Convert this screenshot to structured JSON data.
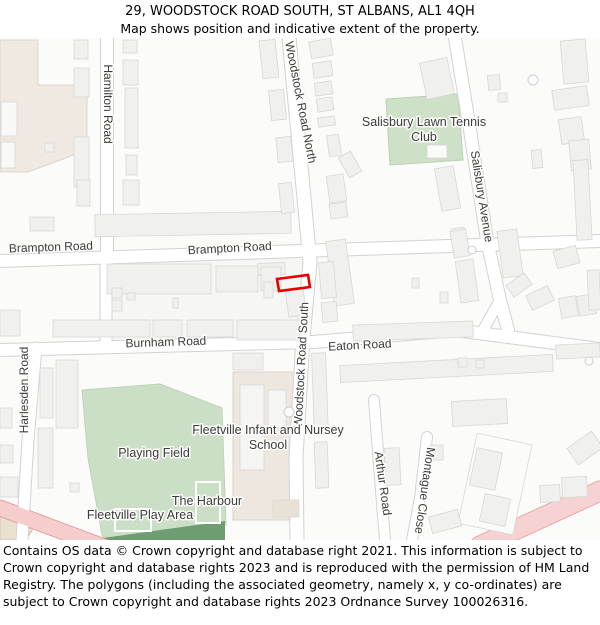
{
  "header": {
    "title": "29, WOODSTOCK ROAD SOUTH, ST ALBANS, AL1 4QH",
    "subtitle": "Map shows position and indicative extent of the property."
  },
  "footer": {
    "text": "Contains OS data © Crown copyright and database right 2021. This information is subject to Crown copyright and database rights 2023 and is reproduced with the permission of HM Land Registry. The polygons (including the associated geometry, namely x, y co-ordinates) are subject to Crown copyright and database rights 2023 Ordnance Survey 100026316."
  },
  "map": {
    "colors": {
      "land": "#fbfbfa",
      "block": "#f6f6f5",
      "building": "#f0f0ef",
      "building_stroke": "#d7d7d6",
      "road_fill": "#ffffff",
      "road_casing": "#d2d2d1",
      "green": "#cbdfc6",
      "green_dark": "#6f9d72",
      "beige": "#efe9e1",
      "pink_fill": "#f6cdcd",
      "pink_casing": "#e5a1a1",
      "label": "#3c3c3c",
      "label_halo": "#fdfdfc",
      "property": "#e60000"
    },
    "areas": [
      {
        "name": "residential-block",
        "points": [
          [
            104,
            222
          ],
          [
            313,
            214
          ],
          [
            308,
            302
          ],
          [
            104,
            306
          ]
        ],
        "fill": "#f6f6f5"
      },
      {
        "name": "beige-landuse-nw",
        "points": [
          [
            0,
            2
          ],
          [
            38,
            2
          ],
          [
            38,
            47
          ],
          [
            87,
            47
          ],
          [
            87,
            112
          ],
          [
            28,
            134
          ],
          [
            0,
            134
          ]
        ],
        "fill": "#efe9e1",
        "stroke": "#ddd5c9"
      },
      {
        "name": "tennis-club-green",
        "points": [
          [
            386,
            61
          ],
          [
            458,
            56
          ],
          [
            463,
            122
          ],
          [
            390,
            127
          ]
        ],
        "fill": "#cfe0c9",
        "stroke": "#bad2b2"
      },
      {
        "name": "playing-field-green",
        "points": [
          [
            82,
            352
          ],
          [
            160,
            346
          ],
          [
            222,
            370
          ],
          [
            226,
            487
          ],
          [
            183,
            502
          ],
          [
            103,
            502
          ],
          [
            88,
            420
          ]
        ],
        "fill": "#cbdfc6",
        "stroke": "#bcd4b6"
      },
      {
        "name": "play-area-dark-green",
        "points": [
          [
            103,
            500
          ],
          [
            225,
            483
          ],
          [
            225,
            502
          ],
          [
            103,
            502
          ]
        ],
        "fill": "#6f9d72"
      },
      {
        "name": "school-grounds",
        "points": [
          [
            233,
            334
          ],
          [
            297,
            334
          ],
          [
            289,
            482
          ],
          [
            233,
            482
          ]
        ],
        "fill": "#ede7df",
        "stroke": "#dbd3c7"
      },
      {
        "name": "beige-building-sw",
        "points": [
          [
            0,
            478
          ],
          [
            34,
            489
          ],
          [
            26,
            502
          ],
          [
            0,
            502
          ]
        ],
        "fill": "#e9e0d1",
        "stroke": "#cfc4ae"
      }
    ],
    "roads": [
      {
        "name": "brampton-road",
        "pts": [
          [
            0,
            223
          ],
          [
            600,
            203
          ]
        ],
        "w": 12
      },
      {
        "name": "burnham-road",
        "pts": [
          [
            0,
            312
          ],
          [
            313,
            304
          ]
        ],
        "w": 12
      },
      {
        "name": "eaton-road",
        "pts": [
          [
            313,
            304
          ],
          [
            455,
            292
          ],
          [
            600,
            311
          ]
        ],
        "w": 12
      },
      {
        "name": "hamilton-road",
        "pts": [
          [
            107,
            0
          ],
          [
            107,
            222
          ]
        ],
        "w": 12
      },
      {
        "name": "woodstock-road-north",
        "pts": [
          [
            289,
            0
          ],
          [
            310,
            224
          ]
        ],
        "w": 13
      },
      {
        "name": "woodstock-road-south",
        "pts": [
          [
            310,
            224
          ],
          [
            303,
            300
          ],
          [
            296,
            420
          ],
          [
            297,
            502
          ]
        ],
        "w": 13
      },
      {
        "name": "salisbury-avenue",
        "pts": [
          [
            455,
            0
          ],
          [
            470,
            92
          ],
          [
            487,
            202
          ],
          [
            500,
            262
          ],
          [
            508,
            292
          ]
        ],
        "w": 12
      },
      {
        "name": "salisbury-fork",
        "pts": [
          [
            500,
            262
          ],
          [
            482,
            294
          ]
        ],
        "w": 10
      },
      {
        "name": "harlesden-road",
        "pts": [
          [
            36,
            310
          ],
          [
            28,
            402
          ],
          [
            22,
            502
          ]
        ],
        "w": 11
      },
      {
        "name": "hamilton-extension",
        "pts": [
          [
            106,
            222
          ],
          [
            106,
            308
          ]
        ],
        "w": 11
      },
      {
        "name": "arthur-road",
        "pts": [
          [
            374,
            362
          ],
          [
            380,
            440
          ],
          [
            385,
            502
          ]
        ],
        "w": 10
      },
      {
        "name": "montague-close",
        "pts": [
          [
            427,
            399
          ],
          [
            420,
            460
          ],
          [
            412,
            502
          ]
        ],
        "w": 10
      },
      {
        "name": "main-road-sw",
        "pts": [
          [
            0,
            470
          ],
          [
            112,
            512
          ]
        ],
        "w": 15,
        "fill": "#f6cdcd",
        "casing": "#e5a1a1"
      },
      {
        "name": "main-road-se",
        "pts": [
          [
            600,
            453
          ],
          [
            480,
            508
          ]
        ],
        "w": 19,
        "fill": "#f6d2d2",
        "casing": "#e5a8a8"
      }
    ],
    "buildings": [
      [
        74,
        2,
        14,
        19
      ],
      [
        74,
        30,
        15,
        29
      ],
      [
        74,
        99,
        15,
        50
      ],
      [
        77,
        142,
        13,
        26
      ],
      [
        45,
        105,
        9,
        9
      ],
      [
        1,
        64,
        16,
        34,
        0,
        "#f8f8f7"
      ],
      [
        1,
        104,
        14,
        26,
        0,
        "#f8f8f7"
      ],
      [
        123,
        2,
        14,
        13
      ],
      [
        123,
        22,
        15,
        25
      ],
      [
        125,
        50,
        13,
        60
      ],
      [
        126,
        117,
        11,
        20
      ],
      [
        123,
        142,
        16,
        25
      ],
      [
        30,
        179,
        24,
        14
      ],
      [
        95,
        175,
        196,
        22,
        -1
      ],
      [
        261,
        2,
        16,
        38,
        -6
      ],
      [
        270,
        52,
        15,
        30,
        -6
      ],
      [
        277,
        99,
        15,
        25,
        -6
      ],
      [
        280,
        145,
        13,
        30,
        -6
      ],
      [
        258,
        225,
        27,
        12,
        -2
      ],
      [
        310,
        2,
        22,
        17,
        -10
      ],
      [
        313,
        24,
        19,
        15,
        -8
      ],
      [
        315,
        44,
        17,
        13,
        -8
      ],
      [
        317,
        60,
        16,
        13,
        -8
      ],
      [
        318,
        79,
        17,
        9,
        -8
      ],
      [
        328,
        97,
        12,
        21,
        -8
      ],
      [
        343,
        115,
        14,
        23,
        -30
      ],
      [
        328,
        137,
        17,
        27,
        -8
      ],
      [
        330,
        165,
        17,
        15,
        -8
      ],
      [
        423,
        22,
        28,
        37,
        -12
      ],
      [
        438,
        129,
        19,
        43,
        -10
      ],
      [
        452,
        190,
        13,
        12,
        -8
      ],
      [
        427,
        107,
        20,
        13,
        0,
        "#fafaf9"
      ],
      [
        562,
        2,
        25,
        43,
        -5
      ],
      [
        553,
        50,
        35,
        20,
        -8
      ],
      [
        560,
        80,
        23,
        25,
        -8
      ],
      [
        570,
        102,
        20,
        30,
        -5
      ],
      [
        532,
        112,
        10,
        18,
        -5
      ],
      [
        575,
        122,
        15,
        80,
        -3
      ],
      [
        498,
        55,
        9,
        9,
        0
      ],
      [
        488,
        37,
        12,
        15,
        -5
      ],
      [
        330,
        202,
        20,
        65,
        -8
      ],
      [
        452,
        192,
        16,
        27,
        -10
      ],
      [
        458,
        222,
        18,
        42,
        -8
      ],
      [
        500,
        192,
        20,
        47,
        -8
      ],
      [
        508,
        240,
        22,
        14,
        -35
      ],
      [
        528,
        252,
        24,
        16,
        -25
      ],
      [
        555,
        210,
        23,
        18,
        -15
      ],
      [
        560,
        259,
        17,
        20,
        -10
      ],
      [
        578,
        257,
        17,
        20,
        -10
      ],
      [
        588,
        232,
        12,
        40,
        -3
      ],
      [
        412,
        240,
        7,
        10
      ],
      [
        440,
        254,
        8,
        11
      ],
      [
        353,
        285,
        120,
        16,
        -2
      ],
      [
        340,
        322,
        213,
        17,
        -3
      ],
      [
        556,
        306,
        44,
        14,
        -3
      ],
      [
        107,
        226,
        104,
        30
      ],
      [
        216,
        228,
        42,
        26
      ],
      [
        261,
        229,
        20,
        24
      ],
      [
        264,
        244,
        9,
        16
      ],
      [
        287,
        252,
        18,
        26,
        -8
      ],
      [
        0,
        272,
        20,
        26
      ],
      [
        53,
        282,
        97,
        17
      ],
      [
        153,
        282,
        29,
        17
      ],
      [
        187,
        282,
        46,
        17
      ],
      [
        237,
        282,
        63,
        20
      ],
      [
        112,
        250,
        10,
        10
      ],
      [
        112,
        262,
        10,
        11
      ],
      [
        127,
        255,
        8,
        7
      ],
      [
        173,
        260,
        5,
        10
      ],
      [
        320,
        224,
        15,
        36,
        -5
      ],
      [
        322,
        264,
        15,
        20,
        -5
      ],
      [
        313,
        315,
        14,
        82,
        -2
      ],
      [
        315,
        404,
        13,
        46,
        -2
      ],
      [
        233,
        315,
        30,
        17
      ],
      [
        240,
        347,
        24,
        85,
        0,
        "#f5f5f4"
      ],
      [
        268,
        352,
        18,
        38,
        0,
        "#f5f5f4"
      ],
      [
        273,
        462,
        26,
        17,
        0,
        "#e9e1d6"
      ],
      [
        0,
        370,
        12,
        20
      ],
      [
        0,
        407,
        13,
        18
      ],
      [
        0,
        439,
        18,
        20
      ],
      [
        40,
        330,
        13,
        50
      ],
      [
        38,
        390,
        15,
        60
      ],
      [
        70,
        445,
        9,
        9
      ],
      [
        56,
        322,
        22,
        68
      ],
      [
        385,
        410,
        15,
        37,
        -3
      ],
      [
        430,
        407,
        13,
        15
      ],
      [
        452,
        362,
        55,
        25,
        -3
      ],
      [
        458,
        320,
        9,
        9
      ],
      [
        476,
        322,
        8,
        8
      ],
      [
        467,
        400,
        56,
        92,
        12,
        "#fbfbfa"
      ],
      [
        473,
        412,
        26,
        38,
        12
      ],
      [
        482,
        458,
        26,
        28,
        12
      ],
      [
        540,
        447,
        20,
        17,
        -3
      ],
      [
        562,
        439,
        25,
        20,
        -3
      ],
      [
        570,
        400,
        30,
        20,
        -35
      ],
      [
        430,
        475,
        30,
        17,
        -15
      ]
    ],
    "white_outlines": [
      {
        "name": "harbour-enclosure",
        "x": 196,
        "y": 444,
        "w": 24,
        "h": 41
      },
      {
        "name": "playground-enclosure",
        "x": 115,
        "y": 471,
        "w": 36,
        "h": 22
      }
    ],
    "circles": [
      [
        533,
        42,
        5
      ],
      [
        289,
        374,
        5
      ],
      [
        472,
        212,
        4
      ],
      [
        589,
        323,
        4
      ]
    ],
    "property": {
      "name": "29-woodstock-road-south-plot",
      "points": [
        [
          277,
          241
        ],
        [
          308,
          237
        ],
        [
          310,
          249
        ],
        [
          279,
          253
        ]
      ]
    },
    "labels": [
      {
        "name": "hamilton-road",
        "text": "Hamilton Road",
        "x": 104,
        "y": 66,
        "rot": 90,
        "size": 12
      },
      {
        "name": "woodstock-road-north",
        "text": "Woodstock Road North",
        "x": 297,
        "y": 65,
        "rot": 79,
        "size": 12
      },
      {
        "name": "woodstock-road-south",
        "text": "Woodstock Road South",
        "x": 305,
        "y": 327,
        "rot": -87,
        "size": 12
      },
      {
        "name": "brampton-road-west",
        "text": "Brampton Road",
        "x": 51,
        "y": 213,
        "rot": -2,
        "size": 12
      },
      {
        "name": "brampton-road-east",
        "text": "Brampton Road",
        "x": 230,
        "y": 214,
        "rot": -3,
        "size": 12
      },
      {
        "name": "burnham-road",
        "text": "Burnham Road",
        "x": 166,
        "y": 308,
        "rot": -2,
        "size": 12
      },
      {
        "name": "eaton-road",
        "text": "Eaton Road",
        "x": 360,
        "y": 311,
        "rot": -3,
        "size": 12
      },
      {
        "name": "salisbury-avenue",
        "text": "Salisbury Avenue",
        "x": 478,
        "y": 159,
        "rot": 81,
        "size": 12
      },
      {
        "name": "harlesden-road",
        "text": "Harlesden Road",
        "x": 28,
        "y": 352,
        "rot": -90,
        "size": 12
      },
      {
        "name": "arthur-road",
        "text": "Arthur Road",
        "x": 379,
        "y": 446,
        "rot": 82,
        "size": 12
      },
      {
        "name": "montague-close",
        "text": "Montague Close",
        "x": 421,
        "y": 452,
        "rot": 98,
        "size": 12
      },
      {
        "name": "tennis-club-line1",
        "text": "Salisbury Lawn Tennis",
        "x": 424,
        "y": 88,
        "rot": 0,
        "size": 12.5
      },
      {
        "name": "tennis-club-line2",
        "text": "Club",
        "x": 424,
        "y": 103,
        "rot": 0,
        "size": 12.5
      },
      {
        "name": "school-line1",
        "text": "Fleetville Infant and Nursey",
        "x": 268,
        "y": 396,
        "rot": 0,
        "size": 12.5
      },
      {
        "name": "school-line2",
        "text": "School",
        "x": 268,
        "y": 411,
        "rot": 0,
        "size": 12.5
      },
      {
        "name": "playing-field",
        "text": "Playing Field",
        "x": 154,
        "y": 419,
        "rot": 0,
        "size": 12.5
      },
      {
        "name": "the-harbour",
        "text": "The Harbour",
        "x": 207,
        "y": 467,
        "rot": 0,
        "size": 12.5
      },
      {
        "name": "fleetville-play-area",
        "text": "Fleetville Play Area",
        "x": 140,
        "y": 481,
        "rot": 0,
        "size": 12.5
      }
    ]
  }
}
